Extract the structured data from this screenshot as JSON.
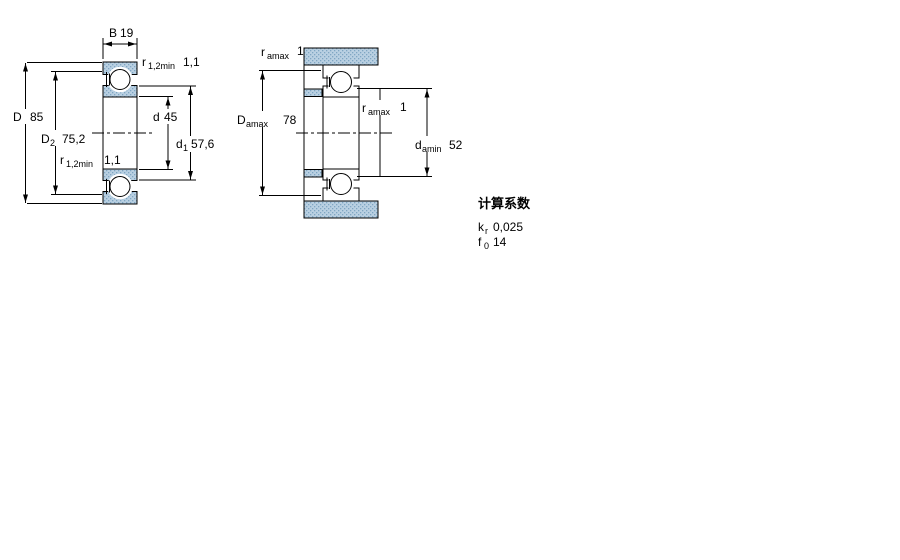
{
  "figure_left": {
    "labels": {
      "width_b": {
        "base": "B",
        "value": "19"
      },
      "r_top": {
        "base": "r",
        "sub": "1,2min",
        "value": "1,1"
      },
      "outer_d": {
        "base": "D",
        "value": "85"
      },
      "d2": {
        "base": "D",
        "sub": "2",
        "value": "75,2"
      },
      "r_bottom": {
        "base": "r",
        "sub": "1,2min",
        "value": "1,1"
      },
      "bore_d": {
        "base": "d",
        "value": "45"
      },
      "d1": {
        "base": "d",
        "sub": "1",
        "value": "57,6"
      }
    }
  },
  "figure_right": {
    "labels": {
      "r_top": {
        "base": "r",
        "sub": "amax",
        "value": "1"
      },
      "da_max": {
        "base": "D",
        "sub": "amax",
        "value": "78"
      },
      "r_mid": {
        "base": "r",
        "sub": "amax",
        "value": "1"
      },
      "da_min": {
        "base": "d",
        "sub": "amin",
        "value": "52"
      }
    }
  },
  "factors": {
    "title": "计算系数",
    "kr": {
      "base": "k",
      "sub": "r",
      "value": "0,025"
    },
    "f0": {
      "base": "f",
      "sub": "0",
      "value": "14"
    }
  },
  "colors": {
    "hatch_fill": "#b9d0e2",
    "hatch_dot": "#7fa6c3",
    "line": "#000000"
  }
}
